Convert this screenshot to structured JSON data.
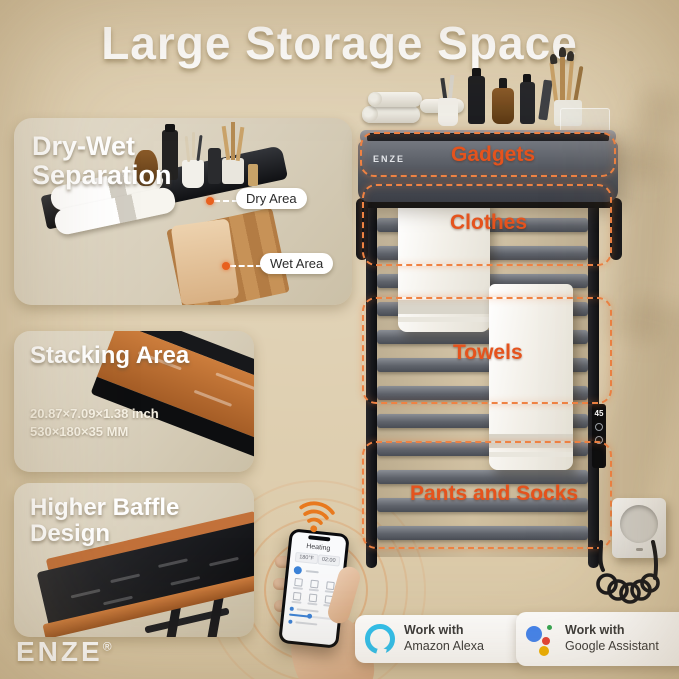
{
  "title": "Large Storage Space",
  "brand": {
    "name": "ENZE",
    "registered_mark": "®"
  },
  "panels": {
    "dry_wet": {
      "title": "Dry-Wet Separation",
      "dry_area_label": "Dry Area",
      "wet_area_label": "Wet Area"
    },
    "stacking": {
      "title": "Stacking Area",
      "dimensions_inch": "20.87×7.09×1.38 inch",
      "dimensions_mm": "530×180×35 MM"
    },
    "baffle": {
      "title": "Higher Baffle Design"
    }
  },
  "rack": {
    "shelf_logo": "ENZE",
    "callouts": {
      "gadgets": "Gadgets",
      "clothes": "Clothes",
      "towels": "Towels",
      "pants_socks": "Pants and Socks"
    },
    "control_display_value": "45"
  },
  "phone_app": {
    "title": "Heating",
    "temperature_value": "180°F",
    "timer_value": "02:00"
  },
  "badges": {
    "alexa": {
      "line1": "Work with",
      "line2": "Amazon Alexa"
    },
    "google": {
      "line1": "Work with",
      "line2": "Google Assistant"
    }
  },
  "colors": {
    "background": "#D8C7A4",
    "callout_orange": "#EF8243",
    "label_orange": "#E5531D",
    "wifi_orange": "#E8791E",
    "alexa_blue": "#2FC3F2",
    "google_blue": "#4285F4",
    "google_red": "#EA4335",
    "google_yellow": "#F4B400",
    "google_green": "#34A853"
  }
}
